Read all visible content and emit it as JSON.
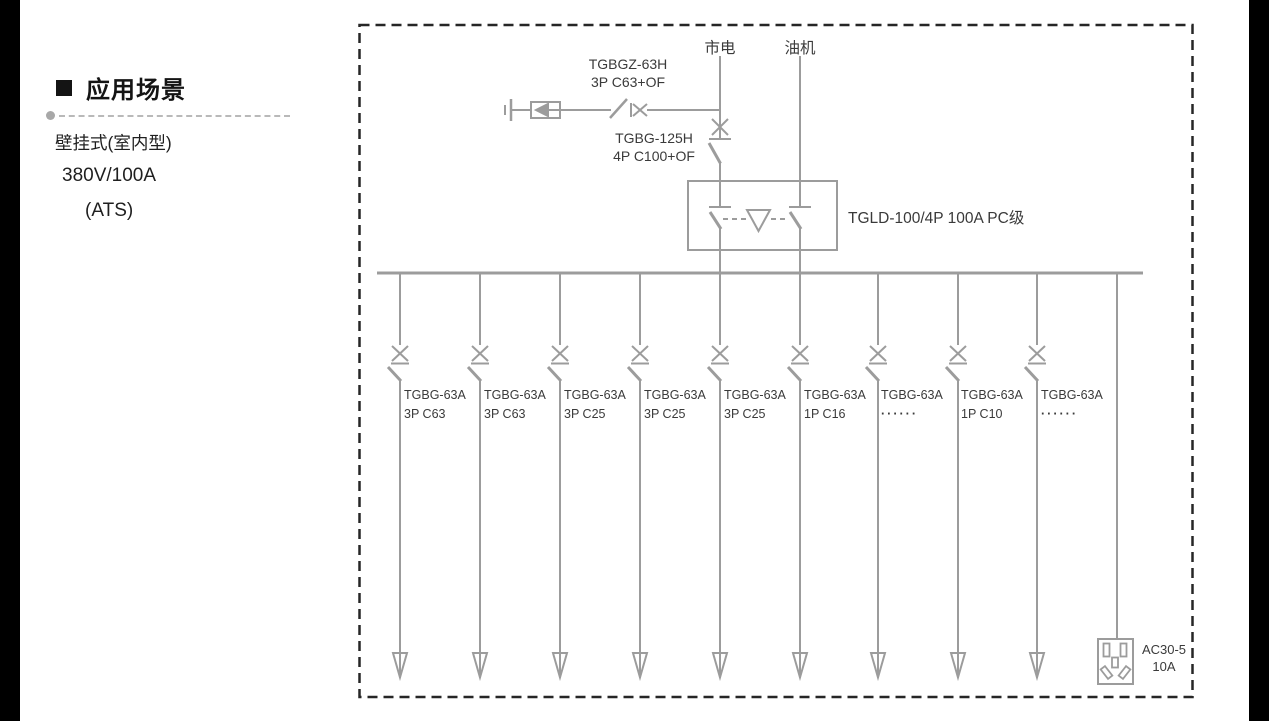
{
  "sidebar": {
    "heading": "应用场景",
    "lines": [
      "壁挂式(室内型)",
      "380V/100A",
      "(ATS)"
    ]
  },
  "diagram": {
    "source_mains": "市电",
    "source_generator": "油机",
    "spd_breaker_line1": "TGBGZ-63H",
    "spd_breaker_line2": "3P C63+OF",
    "main_breaker_line1": "TGBG-125H",
    "main_breaker_line2": "4P C100+OF",
    "ats_label": "TGLD-100/4P 100A PC级",
    "branches": [
      {
        "model": "TGBG-63A",
        "spec": "3P C63"
      },
      {
        "model": "TGBG-63A",
        "spec": "3P C63"
      },
      {
        "model": "TGBG-63A",
        "spec": "3P C25"
      },
      {
        "model": "TGBG-63A",
        "spec": "3P C25"
      },
      {
        "model": "TGBG-63A",
        "spec": "3P C25"
      },
      {
        "model": "TGBG-63A",
        "spec": "1P C16"
      },
      {
        "model": "TGBG-63A",
        "spec": "······"
      },
      {
        "model": "TGBG-63A",
        "spec": "1P C10"
      },
      {
        "model": "TGBG-63A",
        "spec": "······"
      }
    ],
    "socket_model": "AC30-5",
    "socket_rating": "10A"
  },
  "colors": {
    "diagram_line": "#9c9c9c",
    "diagram_text": "#3a3a3a",
    "border_dash": "#262626",
    "edge_bar": "#000000",
    "heading_text": "#141414",
    "separator_dash": "#b9b9b9"
  }
}
